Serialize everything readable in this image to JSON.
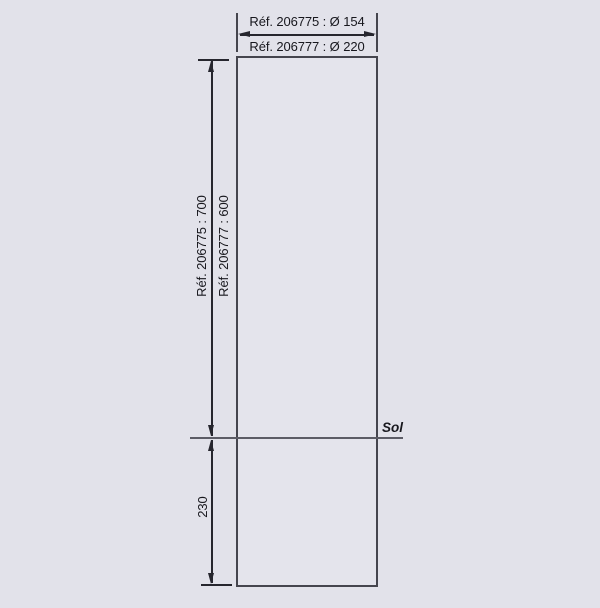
{
  "drawing": {
    "diameter_dimension": {
      "line1": "Réf. 206775 : Ø 154",
      "line2": "Réf. 206777 : Ø 220"
    },
    "height_dimension": {
      "line1": "Réf. 206775 : 700",
      "line2": "Réf. 206777 : 600"
    },
    "ground_label": "Sol",
    "below_ground_dimension": {
      "value": "230"
    },
    "colors": {
      "background": "#e2e2ea",
      "outline": "#45454e",
      "dimension": "#26262e",
      "ground-line": "#5c5c66",
      "text": "#17171d"
    }
  }
}
